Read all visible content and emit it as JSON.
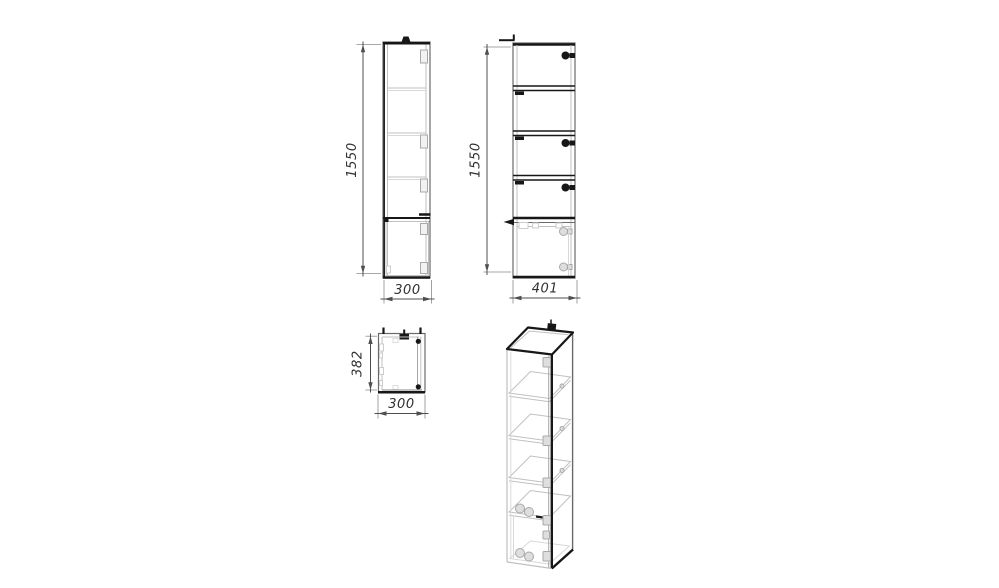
{
  "page": {
    "background": "#ffffff",
    "content": "technical drawing of a tall shelf cabinet, four orthographic/isometric views"
  },
  "palette": {
    "line_dark": "#171717",
    "line_medium": "#6a6a6a",
    "line_light": "#c0c0c0",
    "dimension_line": "#4f4f4f",
    "dimension_text": "#303030"
  },
  "views": {
    "front": {
      "dim_height": "1550",
      "dim_width": "300"
    },
    "side": {
      "dim_height": "1550",
      "dim_width": "401"
    },
    "top": {
      "dim_depth": "382",
      "dim_width": "300"
    }
  }
}
